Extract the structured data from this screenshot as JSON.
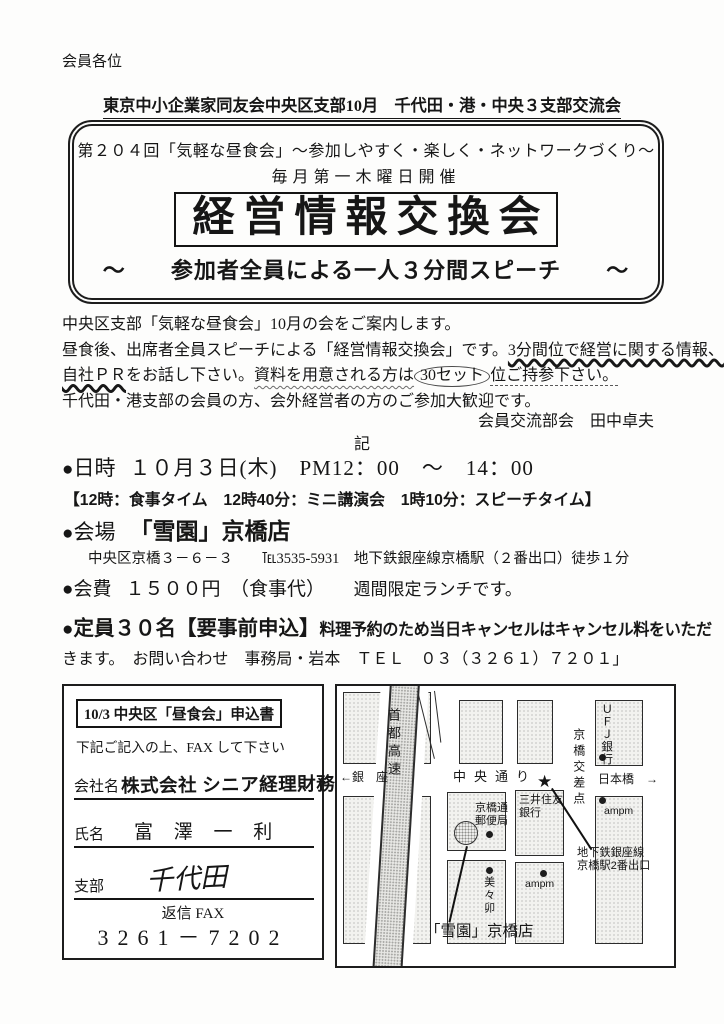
{
  "colors": {
    "ink": "#161616",
    "paper": "#ffffff"
  },
  "header": {
    "recipient": "会員各位",
    "title": "東京中小企業家同友会中央区支部10月　千代田・港・中央３支部交流会"
  },
  "banner": {
    "line1": "第２０４回「気軽な昼食会」～参加しやすく・楽しく・ネットワークづくり～",
    "line2": "毎月第一木曜日開催",
    "title": "経営情報交換会",
    "sub_left": "～",
    "sub_text": "参加者全員による一人３分間スピーチ",
    "sub_right": "～"
  },
  "body": {
    "p1": "中央区支部「気軽な昼食会」10月の会をご案内します。",
    "p2a": "昼食後、出席者全員スピーチによる「経営情報交換会」です。",
    "p2b": "3分間位で経営に関する情報、",
    "p3a": "自社ＰＲ",
    "p3b": "をお話し下さい。",
    "p3c": "資料を用意される方は",
    "p3d": "30セット",
    "p3e": "位ご持参下さい。",
    "p4": "千代田・港支部の会員の方、会外経営者の方のご参加大歓迎です。",
    "signature": "会員交流部会　田中卓夫",
    "ki": "記"
  },
  "details": {
    "bullet": "●",
    "datetime_label": "日時",
    "datetime_value": "１０月３日(木)　PM12：00　～　14：00",
    "schedule": "【12時：食事タイム　12時40分：ミニ講演会　1時10分：スピーチタイム】",
    "venue_label": "会場",
    "venue_value": "「雪園」京橋店",
    "address": "中央区京橋３－６－３　　℡3535-5931　地下鉄銀座線京橋駅（２番出口）徒歩１分",
    "fee_label": "会費",
    "fee_value1": "１５００円　（食事代）　　",
    "fee_value2": "週間限定ランチです。",
    "capacity_label": "定員３０名【要事前申込】",
    "capacity_note1": "料理予約のため当日キャンセルはキャンセル料をいただ",
    "capacity_note2": "きます。　お問い合わせ　事務局・岩本　ＴＥＬ　０３（３２６１）７２０１」"
  },
  "form": {
    "title": "10/3 中央区「昼食会」申込書",
    "instruction": "下記ご記入の上、FAX して下さい",
    "company_label": "会社名",
    "company_value": "株式会社 シニア経理財務",
    "name_label": "氏名",
    "name_value": "富 澤 一 利",
    "branch_label": "支部",
    "branch_value": "千代田",
    "fax_label": "返信 FAX",
    "fax_number": "3261－7202"
  },
  "map": {
    "ginza": "←銀　座",
    "shuto_kosoku": "首都高速",
    "chuo_dori": "中央通り",
    "star": "★",
    "kyobashi_kosaten": "京橋交差点",
    "ufj_bank": "ＵＦＪ銀行",
    "nihonbashi": "日本橋　→",
    "ampm1": "ampm",
    "ampm2": "ampm",
    "mitsui_line1": "三井住友",
    "mitsui_line2": "銀行",
    "post_line1": "京橋通",
    "post_line2": "郵便局",
    "mimiu": "美々卯",
    "subway_line1": "地下鉄銀座線",
    "subway_line2": "京橋駅2番出口",
    "venue": "「雪園」京橋店"
  }
}
